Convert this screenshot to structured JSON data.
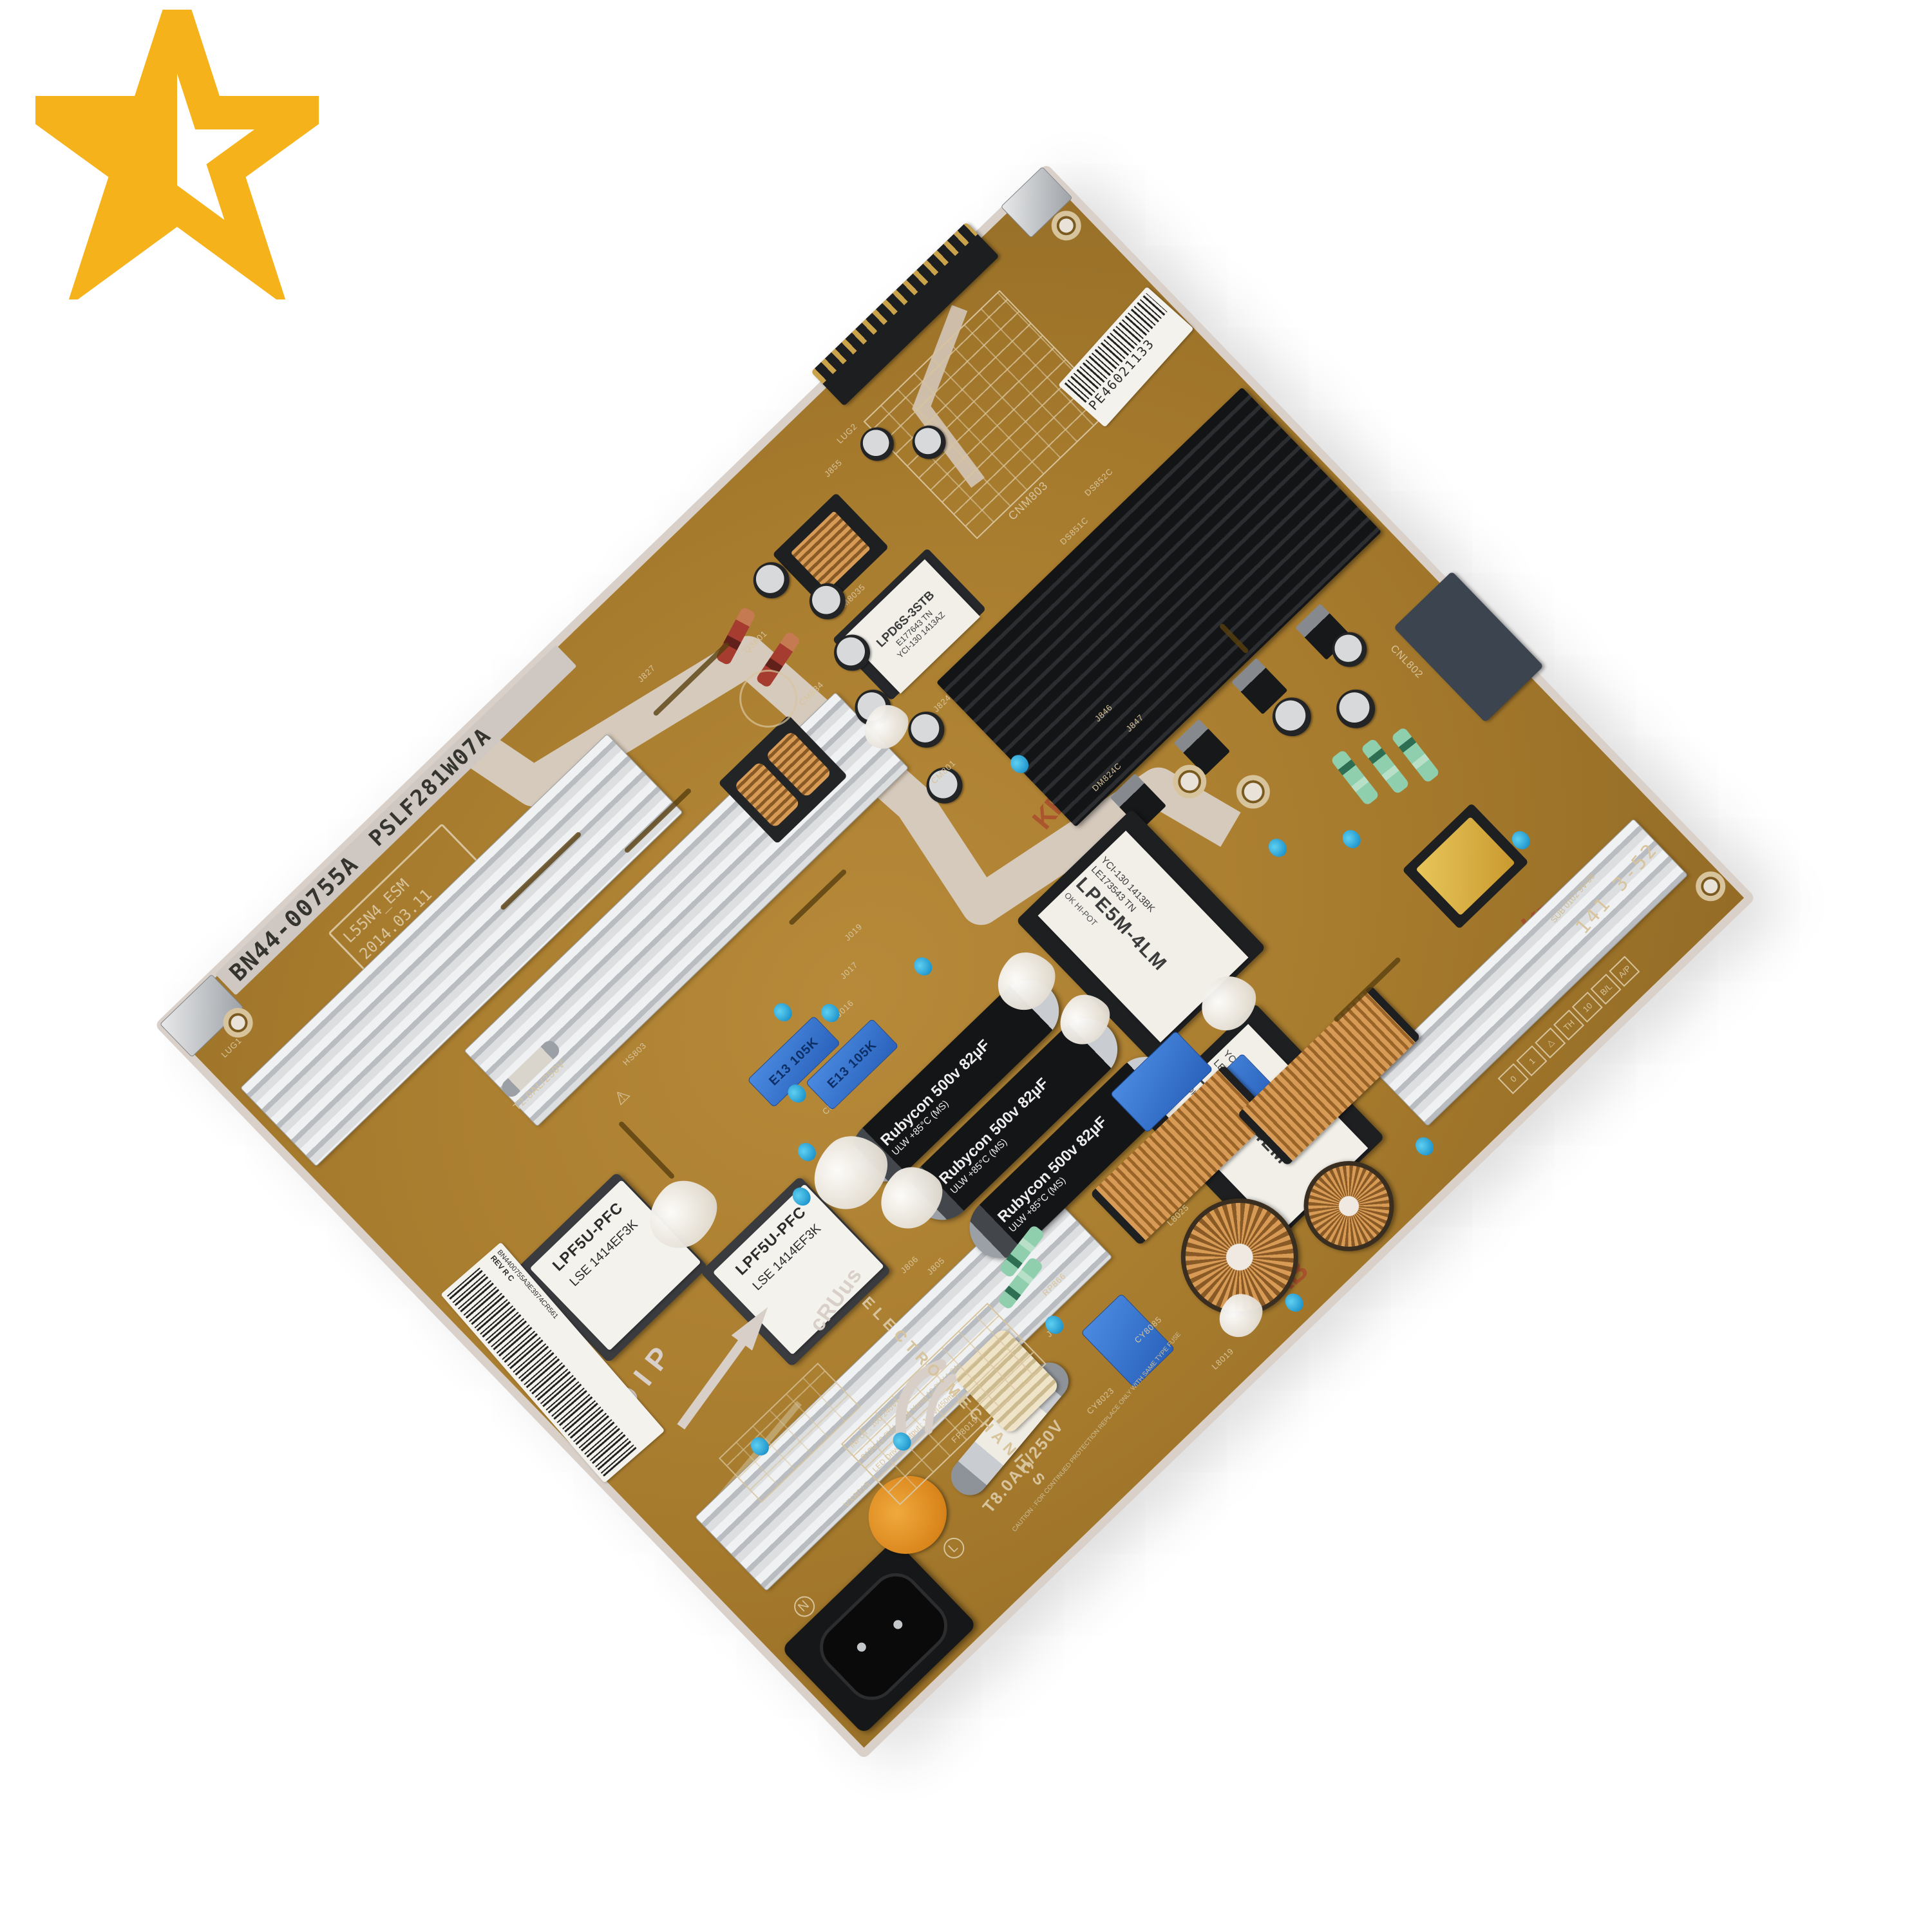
{
  "logo": {
    "name": "half-star",
    "color": "#F5B21B"
  },
  "board": {
    "part_number": "BN44-00755A",
    "board_code": "PSLF281W07A",
    "revision_box": {
      "line1": "L55N4_ESM",
      "line2": "2014.03.11",
      "line3": "Rev 1.1"
    },
    "barcode_sticker": {
      "code": "BN4400755A3E3974CR561",
      "rev": "REV R C"
    },
    "pe_sticker": "PE46021133",
    "dip_marking": "DIP",
    "ul_marking": "cRUus",
    "maker_marking": "ELECTRO-MECHANICS",
    "date_code": "141 3-52",
    "sub_code": "SUB 0102 9V-06",
    "kb_stamp": "KB",
    "fuse_rating": "T8.0AH/250V",
    "fuse2_rating": "T2.0AL/250V",
    "inlet": {
      "neutral": "N",
      "line": "L"
    },
    "spec_table": {
      "r1": "INPUT : 100-240V~ 50/60Hz 2.5A",
      "r2": "B13V 12.8V / 11.6A   Vamp 12.8V / 1.0A",
      "r3": "LED Driver Output : 133V 450mA"
    },
    "safety_text": "CAUTION : FOR CONTINUED PROTECTION REPLACE ONLY WITH SAME TYPE FUSE",
    "transformers": {
      "main": {
        "logo": "OK HI-POT",
        "name": "LPE5M-4LM",
        "line2": "LE173543 TN",
        "line3": "YCI-130 1413BK"
      },
      "pfc": {
        "name": "LPF5U-PFC",
        "line2": "LSE 1414EF3K"
      },
      "aux": {
        "name": "LPD6S-3STB",
        "line2": "E177643 TN",
        "line3": "YCI-130 1413AZ"
      }
    },
    "bulk_capacitor": {
      "brand": "Rubycon",
      "value": "500v 82µF",
      "line2": "ULW  +85°C  (MS)"
    },
    "film_cap": "E13 105K",
    "connectors": {
      "output": "CNM803",
      "aux": "CNL802"
    },
    "warning_icon": "⚠",
    "refs": [
      "J846",
      "J847",
      "DS851C",
      "DS852C",
      "CM801",
      "J824",
      "CM813",
      "CM816",
      "J016",
      "J017",
      "J019",
      "CP8035",
      "J806",
      "J805",
      "RP866",
      "J818",
      "TM8035",
      "HS803",
      "L8025",
      "L8019",
      "VX8015",
      "FP8019",
      "CY8023",
      "CY8085",
      "J827",
      "Q3801",
      "CM834",
      "DM824C",
      "LUG1",
      "LUG2",
      "J855"
    ],
    "edge_pin_boxes": [
      "0",
      "1",
      "△",
      "TH",
      "10",
      "B/L",
      "A/P"
    ]
  }
}
